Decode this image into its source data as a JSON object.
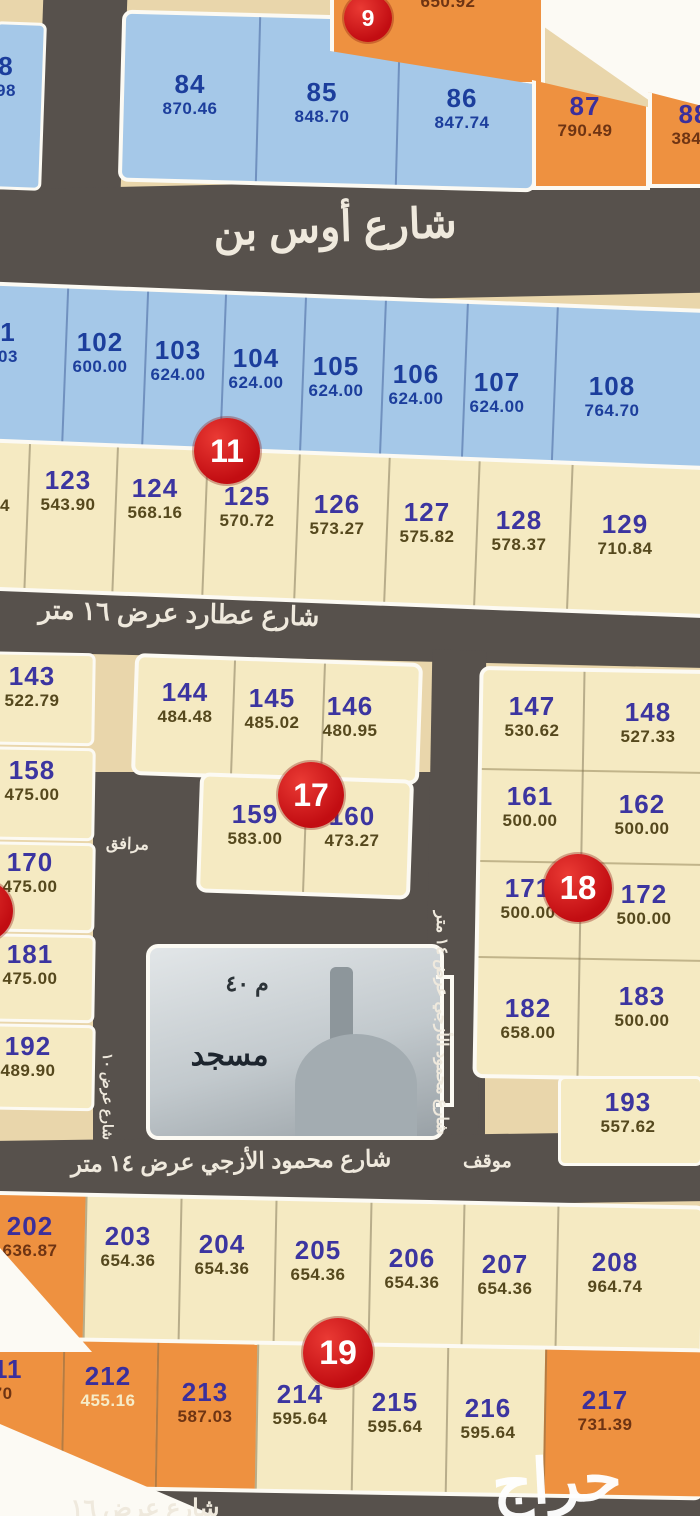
{
  "app": {
    "watermark": "حراج"
  },
  "streets": {
    "aws_label": "شارع أوس بن",
    "atarid_label": "شارع عطارد عرض ١٦ متر",
    "mahmoud_label": "شارع محمود الأزجي عرض ١٤ متر",
    "mahmoud_vertical_label": "شارع محمود الأزجي عرض ١٤ متر",
    "side_vertical_label": "شارع عرض ١٠",
    "bottom_label": "شارع عرض ١٦",
    "parking_label": "موقف",
    "utilities_label": "مرافق"
  },
  "mosque": {
    "name": "مسجد",
    "size": "م ٤٠"
  },
  "badges": [
    {
      "label": "9",
      "x": 344,
      "y": -6,
      "d": 48
    },
    {
      "label": "11",
      "x": 194,
      "y": 418,
      "d": 66
    },
    {
      "label": "17",
      "x": 278,
      "y": 762,
      "d": 66
    },
    {
      "label": "18",
      "x": 544,
      "y": 854,
      "d": 68
    },
    {
      "label": "19",
      "x": 303,
      "y": 1318,
      "d": 70
    },
    {
      "label": "",
      "x": -49,
      "y": 880,
      "d": 62
    }
  ],
  "plots": [
    {
      "num": "8",
      "value": "98",
      "x": 6,
      "y": 52,
      "c": "b"
    },
    {
      "num": "84",
      "value": "870.46",
      "x": 190,
      "y": 70,
      "c": "b"
    },
    {
      "num": "85",
      "value": "848.70",
      "x": 322,
      "y": 78,
      "c": "b"
    },
    {
      "num": "86",
      "value": "847.74",
      "x": 462,
      "y": 84,
      "c": "b"
    },
    {
      "num": "",
      "value": "650.92",
      "x": 448,
      "y": -8,
      "c": "o"
    },
    {
      "num": "87",
      "value": "790.49",
      "x": 585,
      "y": 92,
      "c": "o"
    },
    {
      "num": "88",
      "value": "384.1",
      "x": 694,
      "y": 100,
      "c": "o"
    },
    {
      "num": "1",
      "value": "03",
      "x": 8,
      "y": 318,
      "c": "b"
    },
    {
      "num": "102",
      "value": "600.00",
      "x": 100,
      "y": 328,
      "c": "b"
    },
    {
      "num": "103",
      "value": "624.00",
      "x": 178,
      "y": 336,
      "c": "b"
    },
    {
      "num": "104",
      "value": "624.00",
      "x": 256,
      "y": 344,
      "c": "b"
    },
    {
      "num": "105",
      "value": "624.00",
      "x": 336,
      "y": 352,
      "c": "b"
    },
    {
      "num": "106",
      "value": "624.00",
      "x": 416,
      "y": 360,
      "c": "b"
    },
    {
      "num": "107",
      "value": "624.00",
      "x": 497,
      "y": 368,
      "c": "b"
    },
    {
      "num": "108",
      "value": "764.70",
      "x": 612,
      "y": 372,
      "c": "b"
    },
    {
      "num": "",
      "value": "4",
      "x": 5,
      "y": 496,
      "c": "c"
    },
    {
      "num": "123",
      "value": "543.90",
      "x": 68,
      "y": 466,
      "c": "c"
    },
    {
      "num": "124",
      "value": "568.16",
      "x": 155,
      "y": 474,
      "c": "c"
    },
    {
      "num": "125",
      "value": "570.72",
      "x": 247,
      "y": 482,
      "c": "c"
    },
    {
      "num": "126",
      "value": "573.27",
      "x": 337,
      "y": 490,
      "c": "c"
    },
    {
      "num": "127",
      "value": "575.82",
      "x": 427,
      "y": 498,
      "c": "c"
    },
    {
      "num": "128",
      "value": "578.37",
      "x": 519,
      "y": 506,
      "c": "c"
    },
    {
      "num": "129",
      "value": "710.84",
      "x": 625,
      "y": 510,
      "c": "c"
    },
    {
      "num": "143",
      "value": "522.79",
      "x": 32,
      "y": 662,
      "c": "c"
    },
    {
      "num": "158",
      "value": "475.00",
      "x": 32,
      "y": 756,
      "c": "c"
    },
    {
      "num": "170",
      "value": "475.00",
      "x": 30,
      "y": 848,
      "c": "c"
    },
    {
      "num": "181",
      "value": "475.00",
      "x": 30,
      "y": 940,
      "c": "c"
    },
    {
      "num": "192",
      "value": "489.90",
      "x": 28,
      "y": 1032,
      "c": "c"
    },
    {
      "num": "144",
      "value": "484.48",
      "x": 185,
      "y": 678,
      "c": "c"
    },
    {
      "num": "145",
      "value": "485.02",
      "x": 272,
      "y": 684,
      "c": "c"
    },
    {
      "num": "146",
      "value": "480.95",
      "x": 350,
      "y": 692,
      "c": "c"
    },
    {
      "num": "159",
      "value": "583.00",
      "x": 255,
      "y": 800,
      "c": "c"
    },
    {
      "num": "160",
      "value": "473.27",
      "x": 352,
      "y": 802,
      "c": "c"
    },
    {
      "num": "147",
      "value": "530.62",
      "x": 532,
      "y": 692,
      "c": "c"
    },
    {
      "num": "148",
      "value": "527.33",
      "x": 648,
      "y": 698,
      "c": "c"
    },
    {
      "num": "161",
      "value": "500.00",
      "x": 530,
      "y": 782,
      "c": "c"
    },
    {
      "num": "162",
      "value": "500.00",
      "x": 642,
      "y": 790,
      "c": "c"
    },
    {
      "num": "171",
      "value": "500.00",
      "x": 528,
      "y": 874,
      "c": "c"
    },
    {
      "num": "172",
      "value": "500.00",
      "x": 644,
      "y": 880,
      "c": "c"
    },
    {
      "num": "182",
      "value": "658.00",
      "x": 528,
      "y": 994,
      "c": "c"
    },
    {
      "num": "183",
      "value": "500.00",
      "x": 642,
      "y": 982,
      "c": "c"
    },
    {
      "num": "193",
      "value": "557.62",
      "x": 628,
      "y": 1088,
      "c": "c"
    },
    {
      "num": "202",
      "value": "636.87",
      "x": 30,
      "y": 1212,
      "c": "o"
    },
    {
      "num": "203",
      "value": "654.36",
      "x": 128,
      "y": 1222,
      "c": "c"
    },
    {
      "num": "204",
      "value": "654.36",
      "x": 222,
      "y": 1230,
      "c": "c"
    },
    {
      "num": "205",
      "value": "654.36",
      "x": 318,
      "y": 1236,
      "c": "c"
    },
    {
      "num": "206",
      "value": "654.36",
      "x": 412,
      "y": 1244,
      "c": "c"
    },
    {
      "num": "207",
      "value": "654.36",
      "x": 505,
      "y": 1250,
      "c": "c"
    },
    {
      "num": "208",
      "value": "964.74",
      "x": 615,
      "y": 1248,
      "c": "c"
    },
    {
      "num": "211",
      "value": ".70",
      "x": 0,
      "y": 1355,
      "c": "o"
    },
    {
      "num": "212",
      "value": "455.16",
      "x": 108,
      "y": 1362,
      "c": "ol"
    },
    {
      "num": "213",
      "value": "587.03",
      "x": 205,
      "y": 1378,
      "c": "o"
    },
    {
      "num": "214",
      "value": "595.64",
      "x": 300,
      "y": 1380,
      "c": "c"
    },
    {
      "num": "215",
      "value": "595.64",
      "x": 395,
      "y": 1388,
      "c": "c"
    },
    {
      "num": "216",
      "value": "595.64",
      "x": 488,
      "y": 1394,
      "c": "c"
    },
    {
      "num": "217",
      "value": "731.39",
      "x": 605,
      "y": 1386,
      "c": "o"
    }
  ]
}
